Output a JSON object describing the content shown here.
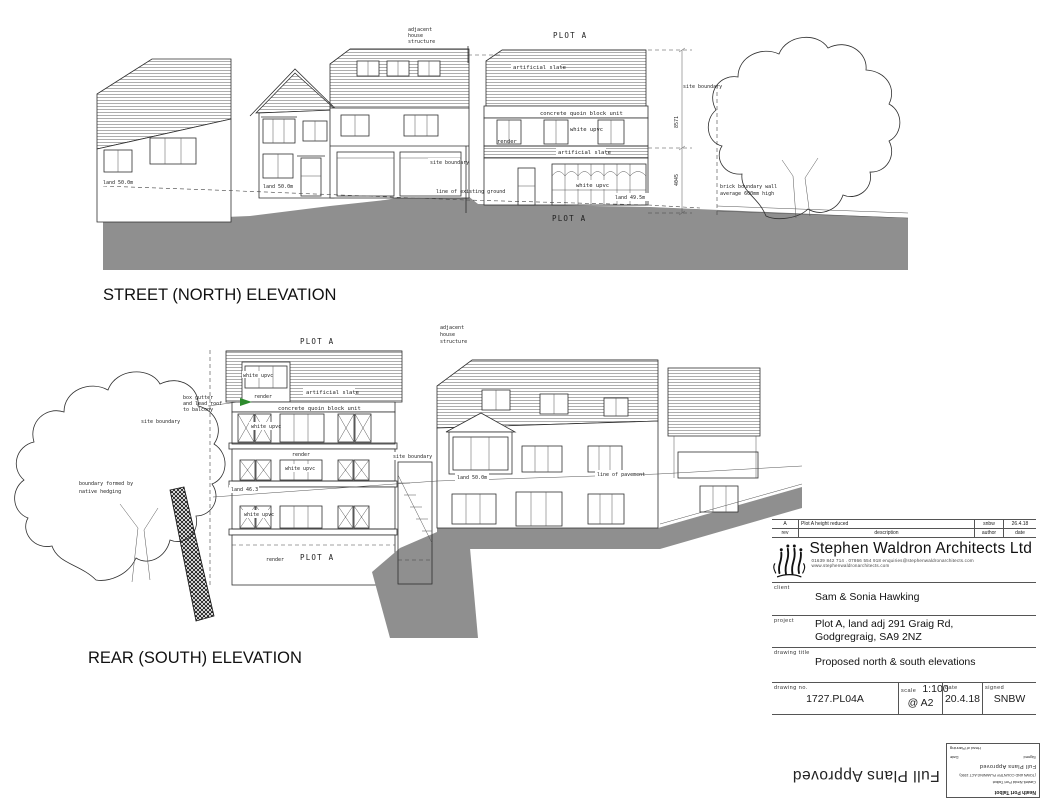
{
  "materials": {
    "slate": "artificial slate",
    "quoin": "concrete quoin block unit",
    "upvc": "white upvc",
    "render": "render"
  },
  "street_elevation": {
    "title": "STREET (NORTH) ELEVATION",
    "plot_title": "PLOT A",
    "plot_ground_label": "PLOT A",
    "adjacent_note": [
      "adjacent",
      "house",
      "structure"
    ],
    "site_boundary": "site boundary",
    "levels": {
      "left": "land 50.0m",
      "mid": "land 50.0m",
      "plot": "land 49.5m"
    },
    "ground_line_note": "line of existing ground",
    "boundary_wall_note": [
      "brick boundary wall",
      "average 600mm high"
    ],
    "dims": {
      "upper": "8571",
      "lower": "4045"
    }
  },
  "rear_elevation": {
    "title": "REAR (SOUTH) ELEVATION",
    "plot_title": "PLOT A",
    "plot_ground_label": "PLOT A",
    "adjacent_note": [
      "adjacent",
      "house",
      "structure"
    ],
    "site_boundary": "site boundary",
    "gutter_note": [
      "box gutter",
      "and lead roof",
      "to balcony"
    ],
    "hedge_note": [
      "boundary formed by",
      "native hedging"
    ],
    "levels": {
      "mid": "land 46.3",
      "right": "land 50.0m"
    },
    "pavement_note": "line of pavement"
  },
  "title_block": {
    "revision": {
      "rev": "A",
      "description": "Plot A height reduced",
      "author": "snbw",
      "date": "26.4.18"
    },
    "revision_headers": {
      "rev": "rev",
      "description": "description",
      "author": "author",
      "date": "date"
    },
    "firm": {
      "name": "Stephen Waldron Architects Ltd",
      "contact": "01639 842 714 . 07866 554 918      enquiries@stephenwaldronarchitects.com     www.stephenwaldronarchitects.com"
    },
    "client": {
      "label": "client",
      "value": "Sam & Sonia Hawking"
    },
    "project": {
      "label": "project",
      "line1": "Plot A, land adj 291 Graig Rd,",
      "line2": "Godgregraig, SA9 2NZ"
    },
    "drawing_title": {
      "label": "drawing title",
      "value": "Proposed north & south elevations"
    },
    "drawing_no": {
      "label": "drawing no.",
      "value": "1727.PL04A"
    },
    "scale": {
      "label": "scale",
      "value": "1:100",
      "sheet": "@ A2"
    },
    "date": {
      "label": "date",
      "value": "20.4.18"
    },
    "signed": {
      "label": "signed",
      "value": "SNBW"
    }
  },
  "stamp": {
    "approval_text": "Full Plans Approved",
    "box": {
      "authority_en": "Neath Port Talbot",
      "authority_cy": "Castell-Nedd Port Talbot",
      "act": "(TOWN AND COUNTRY PLANNING ACT 1990)",
      "status": "Full Plans Approved",
      "signed_label": "Signed",
      "date_label": "Date",
      "officer": "Head of Planning"
    }
  }
}
